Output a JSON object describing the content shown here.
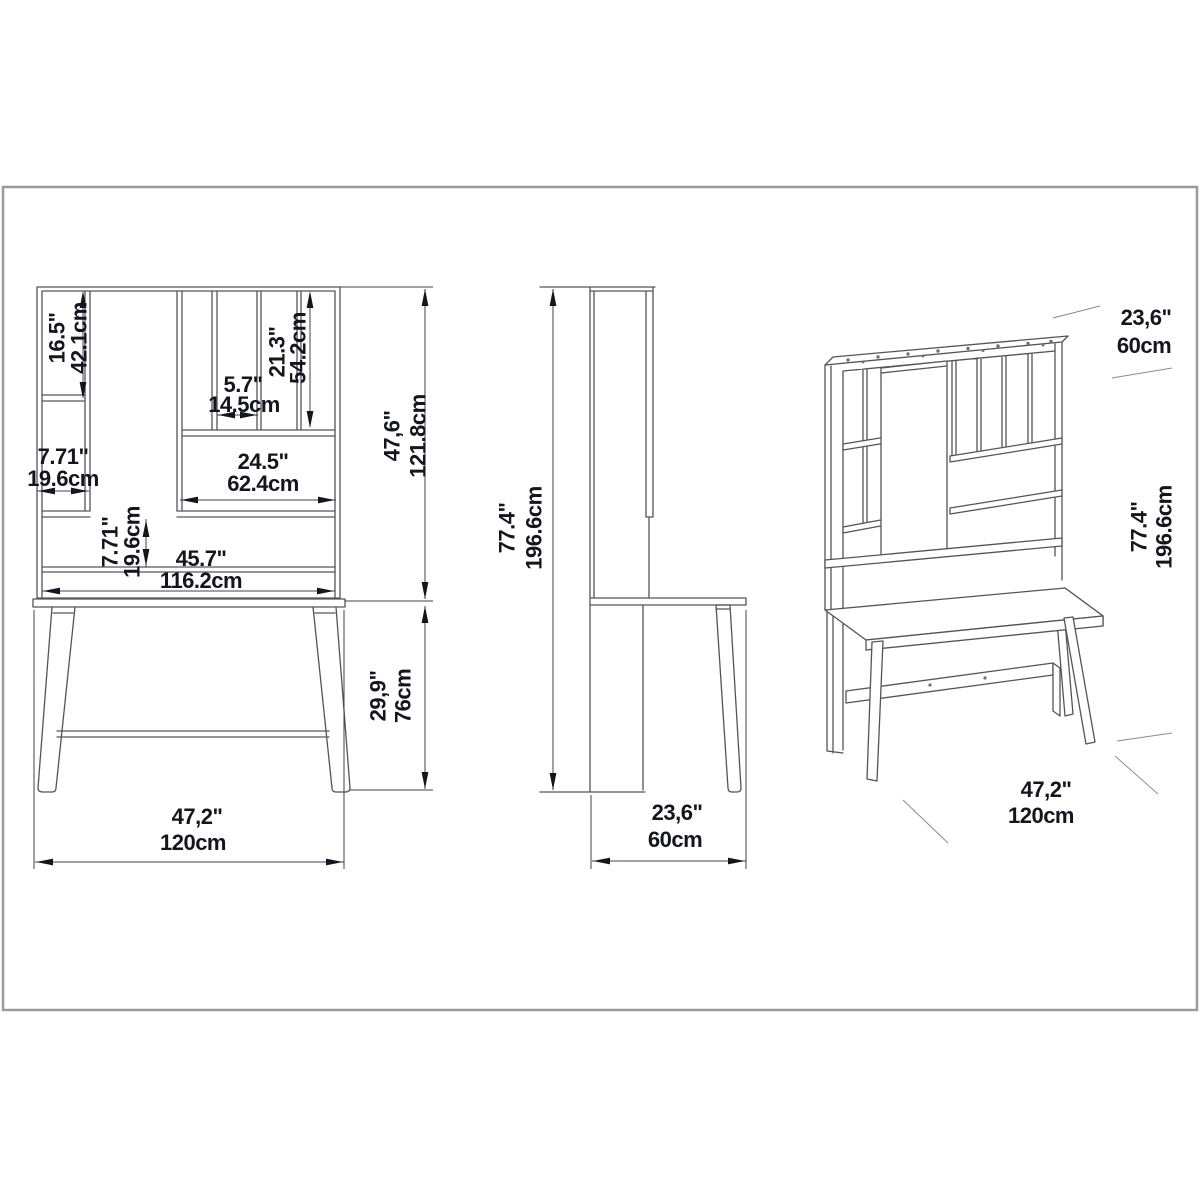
{
  "page": {
    "background": "#ffffff",
    "frame_color": "#9b9b9b",
    "line_color": "#53535c",
    "dim_text_color": "#15151f",
    "description": "Technical dimension drawing of a writing desk with hutch: front view, side view and perspective view"
  },
  "views": {
    "front": {
      "label": "front-view",
      "dims": {
        "left_shelf_height": {
          "inches": "16.5\"",
          "cm": "42.1cm"
        },
        "slot_width": {
          "inches": "5.7\"",
          "cm": "14.5cm"
        },
        "slot_height": {
          "inches": "21.3\"",
          "cm": "54.2cm"
        },
        "left_column_width": {
          "inches": "7.71\"",
          "cm": "19.6cm"
        },
        "open_section_width": {
          "inches": "24.5\"",
          "cm": "62.4cm"
        },
        "shelf_band_height": {
          "inches": "7.71\"",
          "cm": "19.6cm"
        },
        "inner_width": {
          "inches": "45.7\"",
          "cm": "116.2cm"
        },
        "hutch_height": {
          "inches": "47,6\"",
          "cm": "121.8cm"
        },
        "desk_height": {
          "inches": "29,9\"",
          "cm": "76cm"
        },
        "total_width": {
          "inches": "47,2\"",
          "cm": "120cm"
        }
      }
    },
    "side": {
      "label": "side-view",
      "dims": {
        "total_height": {
          "inches": "77.4\"",
          "cm": "196.6cm"
        },
        "depth": {
          "inches": "23,6\"",
          "cm": "60cm"
        }
      }
    },
    "perspective": {
      "label": "perspective-view",
      "dims": {
        "depth": {
          "inches": "23,6\"",
          "cm": "60cm"
        },
        "total_height": {
          "inches": "77.4\"",
          "cm": "196.6cm"
        },
        "total_width": {
          "inches": "47,2\"",
          "cm": "120cm"
        }
      }
    }
  }
}
